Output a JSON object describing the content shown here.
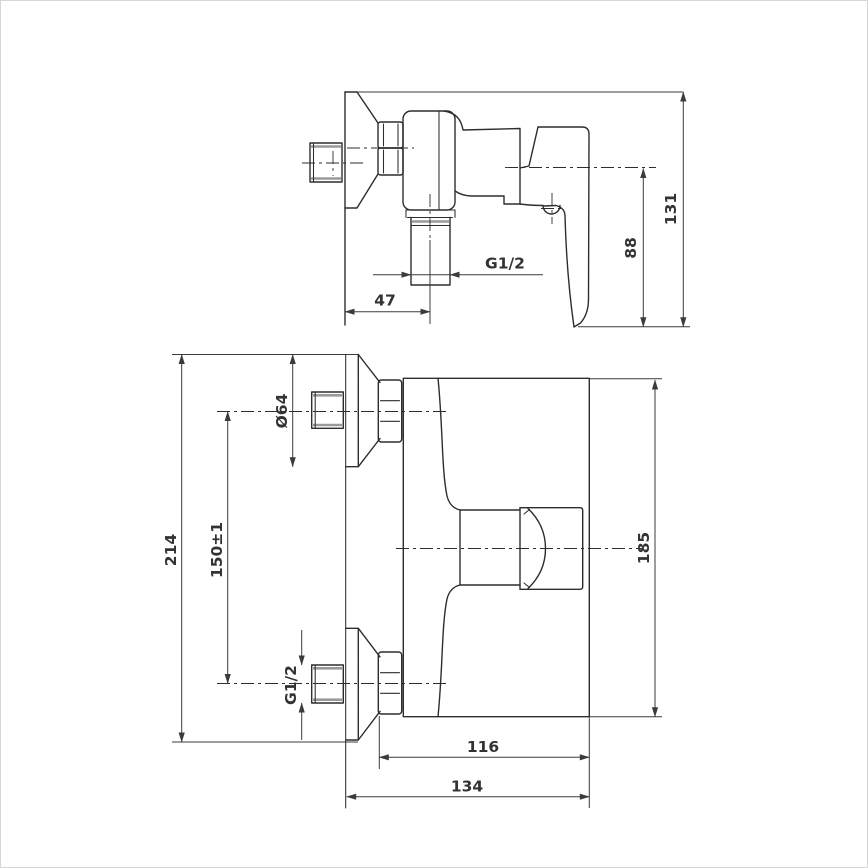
{
  "drawing": {
    "background": "#ffffff",
    "line_color": "#2d2d2d",
    "dimension_line_color": "#3b3b3b",
    "text_color": "#333333",
    "thread_color": "#9a9a9a",
    "side_view": {
      "dim_47": "47",
      "dim_g12": "G1/2",
      "dim_88": "88",
      "dim_131": "131"
    },
    "front_view": {
      "dim_d64": "Ø64",
      "dim_150": "150±1",
      "dim_214": "214",
      "dim_g12": "G1/2",
      "dim_116": "116",
      "dim_134": "134",
      "dim_185": "185"
    }
  }
}
